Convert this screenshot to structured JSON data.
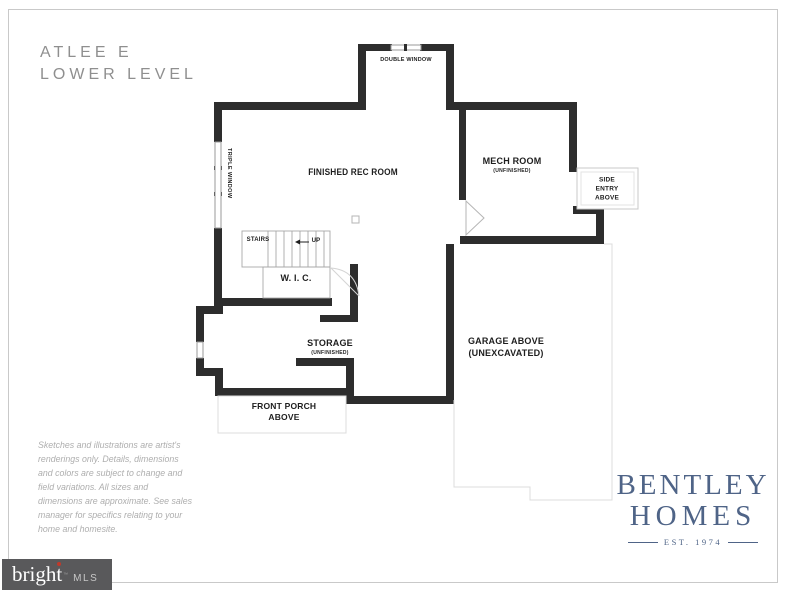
{
  "page": {
    "title_line1": "ATLEE E",
    "title_line2": "LOWER LEVEL"
  },
  "plan": {
    "labels": {
      "double_window": "DOUBLE WINDOW",
      "triple_window": "TRIPLE WINDOW",
      "finished_rec_room": "FINISHED REC ROOM",
      "mech_room": "MECH ROOM",
      "mech_room_sub": "(UNFINISHED)",
      "side_entry": "SIDE ENTRY ABOVE",
      "stairs": "STAIRS",
      "up": "UP",
      "wic": "W. I. C.",
      "storage": "STORAGE",
      "storage_sub": "(UNFINISHED)",
      "front_porch": "FRONT PORCH ABOVE",
      "garage": "GARAGE ABOVE",
      "garage_sub": "(UNEXCAVATED)"
    }
  },
  "disclaimer": "Sketches and illustrations are artist's renderings only. Details, dimensions and colors are subject to change and field variations. All sizes and dimensions are approximate. See sales manager for specifics relating to your home and homesite.",
  "logo": {
    "name_line1": "BENTLEY",
    "name_line2": "HOMES",
    "est": "EST. 1974"
  },
  "watermark": {
    "brand": "bright",
    "trademark": "™",
    "suffix": "MLS"
  },
  "colors": {
    "wall": "#2d2d2d",
    "thin_line": "#a8a8a8",
    "faint_line": "#dcdcdc",
    "title_gray": "#8f8f8f",
    "logo_blue": "#4f6487",
    "watermark_bg": "#59595b",
    "watermark_dot_red": "#c0392b"
  }
}
